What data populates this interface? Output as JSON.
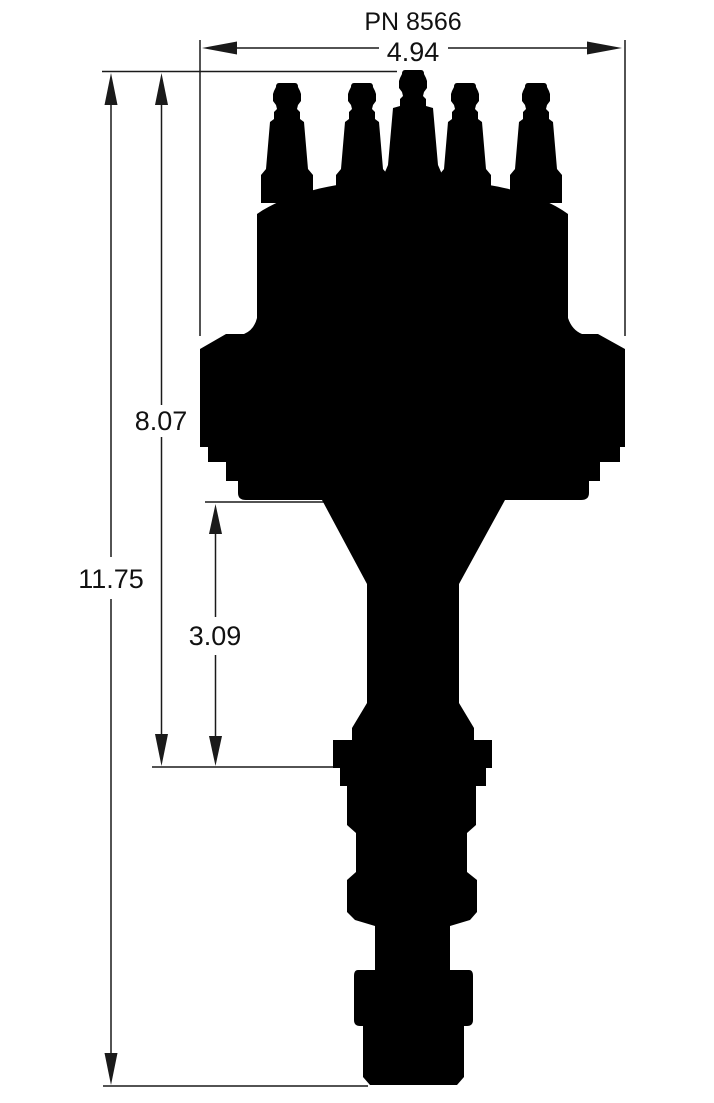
{
  "drawing": {
    "part_number": "PN 8566",
    "dimensions": {
      "cap_width": "4.94",
      "overall_height": "11.75",
      "body_height": "8.07",
      "lower_section": "3.09"
    },
    "colors": {
      "ink": "#1a1a1a",
      "silhouette": "#000000",
      "background": "#ffffff"
    }
  }
}
